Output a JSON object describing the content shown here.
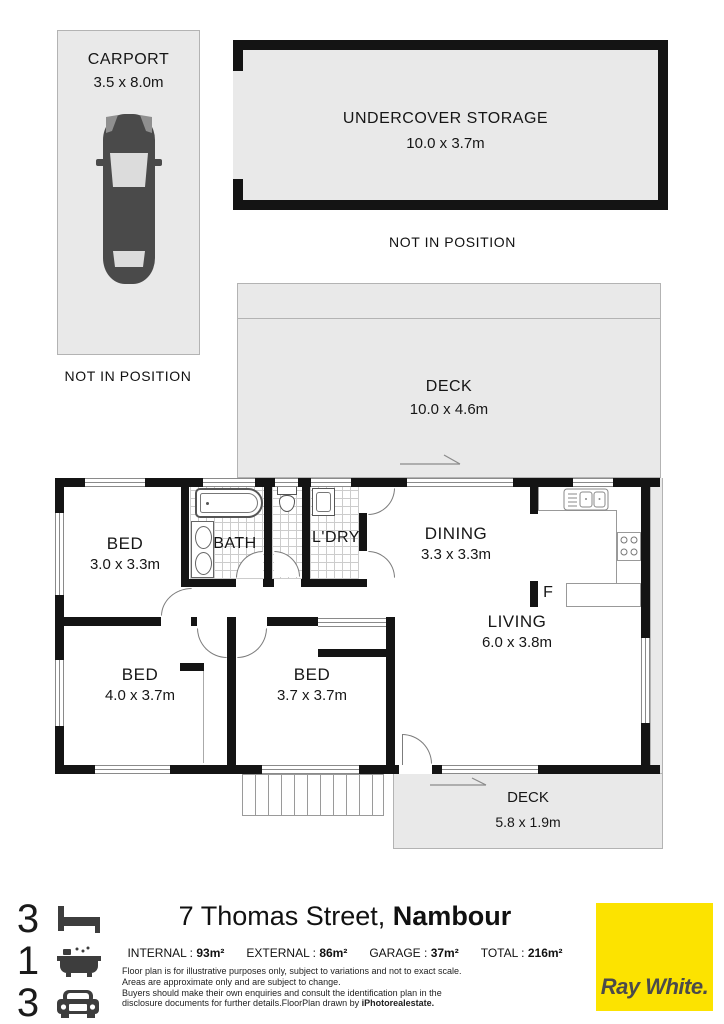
{
  "colors": {
    "area_fill": "#e9e9e9",
    "wall": "#141414",
    "brand_yellow": "#FCE300",
    "brand_text": "#4b4b4b"
  },
  "plan": {
    "carport": {
      "name": "CARPORT",
      "dims": "3.5 x 8.0m"
    },
    "carport_note": "NOT IN POSITION",
    "storage": {
      "name": "UNDERCOVER STORAGE",
      "dims": "10.0 x 3.7m"
    },
    "storage_note": "NOT IN POSITION",
    "deck_top": {
      "name": "DECK",
      "dims": "10.0 x 4.6m"
    },
    "deck_bottom": {
      "name": "DECK",
      "dims": "5.8 x 1.9m"
    },
    "bed1": {
      "name": "BED",
      "dims": "3.0 x 3.3m"
    },
    "bed2": {
      "name": "BED",
      "dims": "4.0 x 3.7m"
    },
    "bed3": {
      "name": "BED",
      "dims": "3.7 x 3.7m"
    },
    "bath": {
      "name": "BATH"
    },
    "laundry": {
      "name": "L'DRY"
    },
    "dining": {
      "name": "DINING",
      "dims": "3.3 x 3.3m"
    },
    "living": {
      "name": "LIVING",
      "dims": "6.0 x 3.8m"
    },
    "fridge_label": "F"
  },
  "footer": {
    "bedrooms": "3",
    "bathrooms": "1",
    "car_spaces": "3",
    "address_street": "7 Thomas Street,",
    "address_suburb": "Nambour",
    "stats": [
      {
        "label": "INTERNAL :",
        "value": "93m²"
      },
      {
        "label": "EXTERNAL :",
        "value": "86m²"
      },
      {
        "label": "GARAGE :",
        "value": "37m²"
      },
      {
        "label": "TOTAL :",
        "value": "216m²"
      }
    ],
    "disclaimer": [
      "Floor plan is for illustrative purposes only, subject to variations and not to exact scale.",
      "Areas are approximate only and are subject to change.",
      "Buyers should make their own enquiries and consult the identification plan in the",
      "disclosure documents for further details.FloorPlan drawn by "
    ],
    "disclaimer_bold": "iPhotorealestate.",
    "brand": "Ray White",
    "brand_dot": "."
  }
}
